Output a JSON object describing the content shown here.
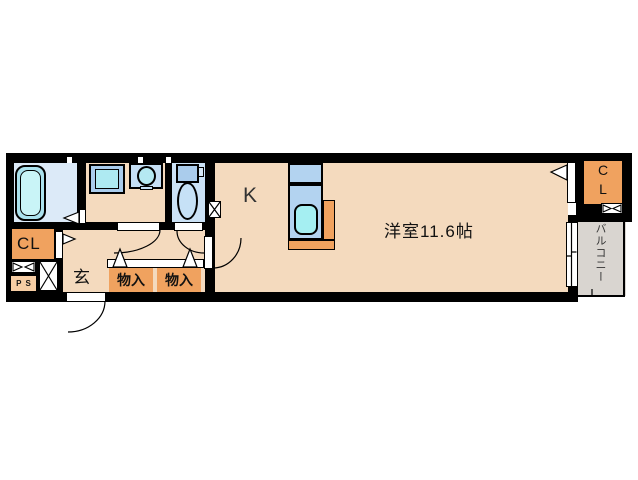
{
  "plan": {
    "labels": {
      "kitchen": "K",
      "main_room": "洋室11.6帖",
      "closet_left": "CL",
      "closet_right_c": "C",
      "closet_right_l": "L",
      "entrance": "玄",
      "storage_1": "物入",
      "storage_2": "物入",
      "pipe_space": "PS",
      "balcony": "バルコニー"
    },
    "colors": {
      "wall": "#000000",
      "floor_tan": "#F4DABE",
      "floor_bath": "#DCEAF8",
      "floor_toilet": "#CBE2F6",
      "balcony_gray": "#D9D5D0",
      "closet_orange": "#F0A25F",
      "fixture_blue": "#AACCEC",
      "water_cyan": "#A8ECF2",
      "pipe_space_peach": "#F6CDA4"
    }
  }
}
